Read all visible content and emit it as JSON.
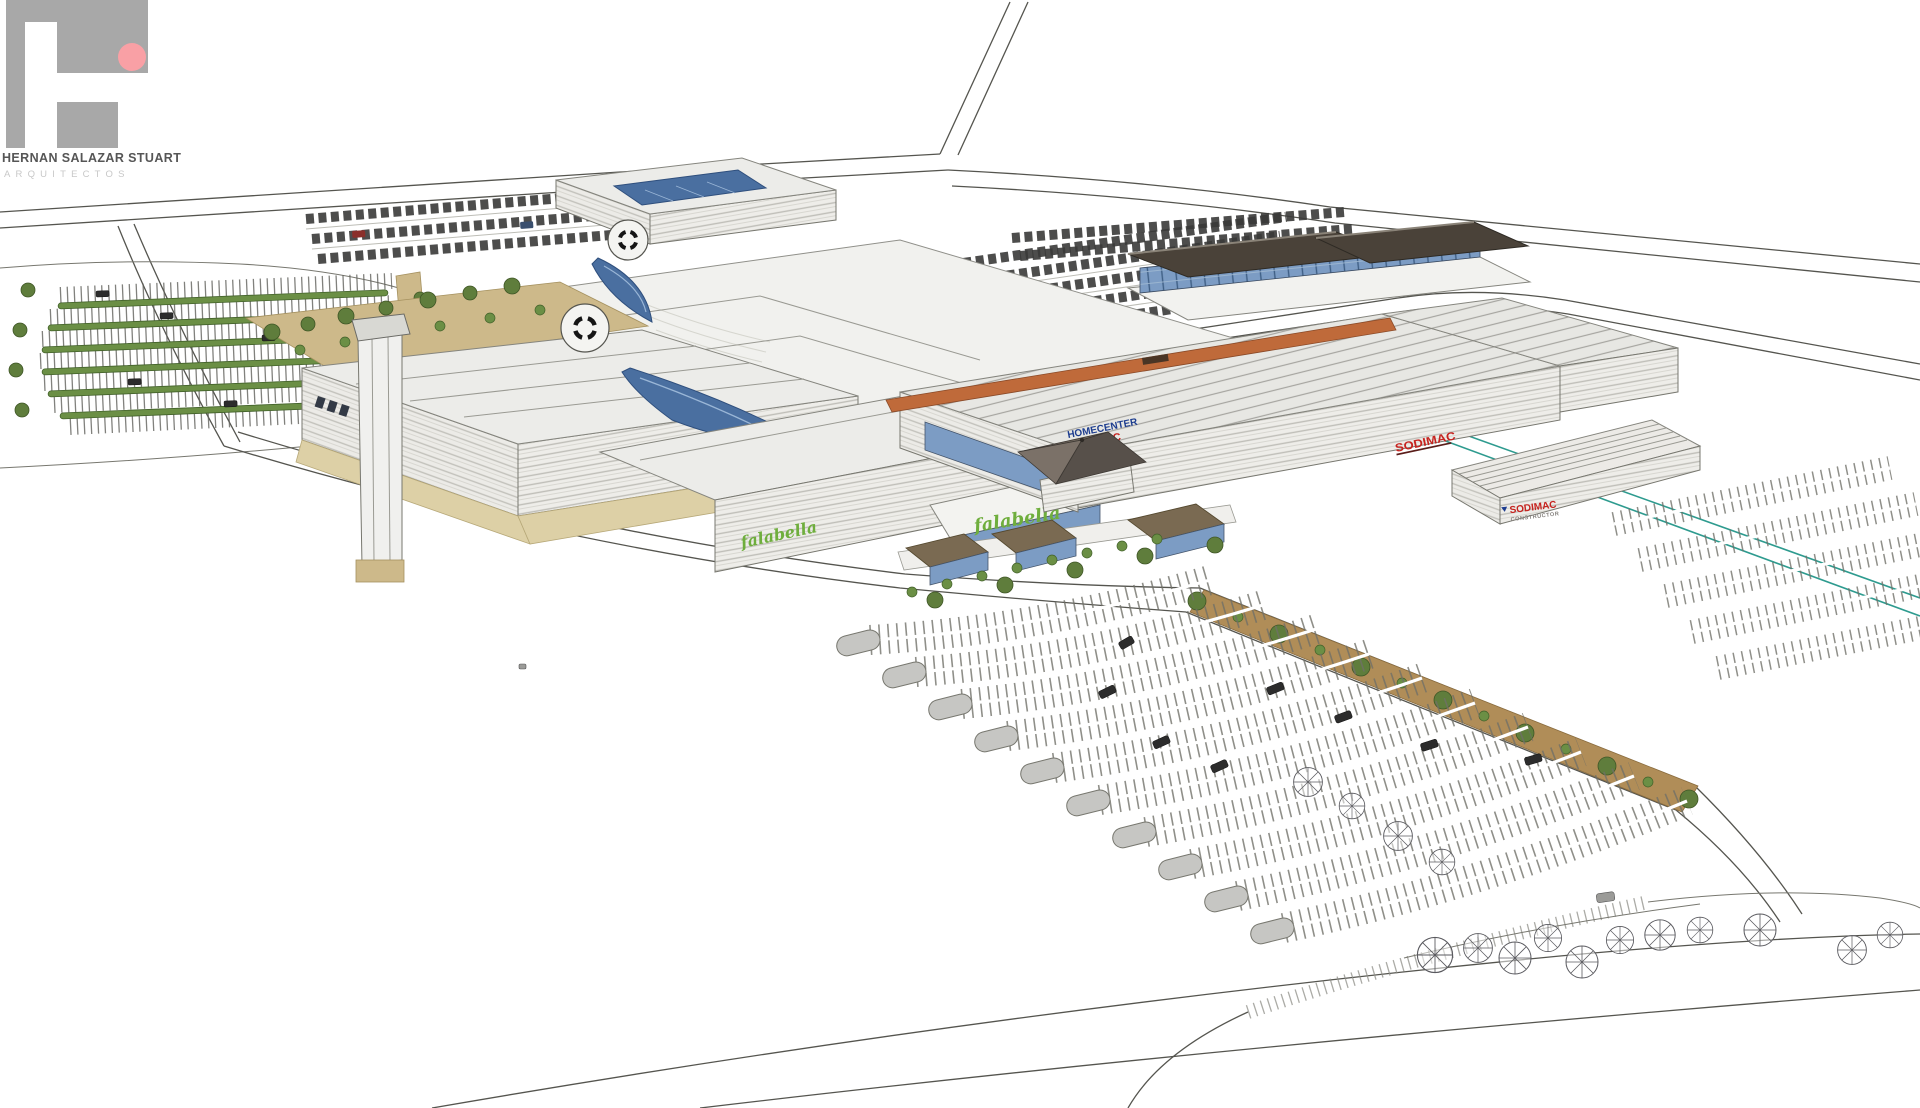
{
  "logo": {
    "firm_name": "HERNAN SALAZAR STUART",
    "firm_subtitle": "ARQUITECTOS"
  },
  "signs": {
    "falabella_wing": "falabella",
    "falabella_entrance": "falabella",
    "homecenter_line1": "HOMECENTER",
    "homecenter_line2": "SODIMAC",
    "sodimac_roof": "SODIMAC",
    "constructor_line1": "SODIMAC",
    "constructor_line2": "CONSTRUCTOR"
  },
  "colors": {
    "page_background": "#ffffff",
    "line_work": "#55554f",
    "falabella_green": "#6fae3d",
    "homecenter_blue": "#1d3d8f",
    "sodimac_red": "#c6231f",
    "canopy_orange": "#bf6a3a",
    "skylight_blue": "#4a6fa0",
    "glass_blue": "#7c9cc4",
    "office_roof_brown": "#4a4239",
    "landscape_tan": "#cdb98a",
    "hedge_green": "#6b8f45",
    "tree_olive": "#5f7d3c",
    "teal_accent": "#2e9b8f",
    "island_gray": "#c6c6c3",
    "logo_gray": "#a8a8a8",
    "logo_pink": "#f9a0a5"
  }
}
